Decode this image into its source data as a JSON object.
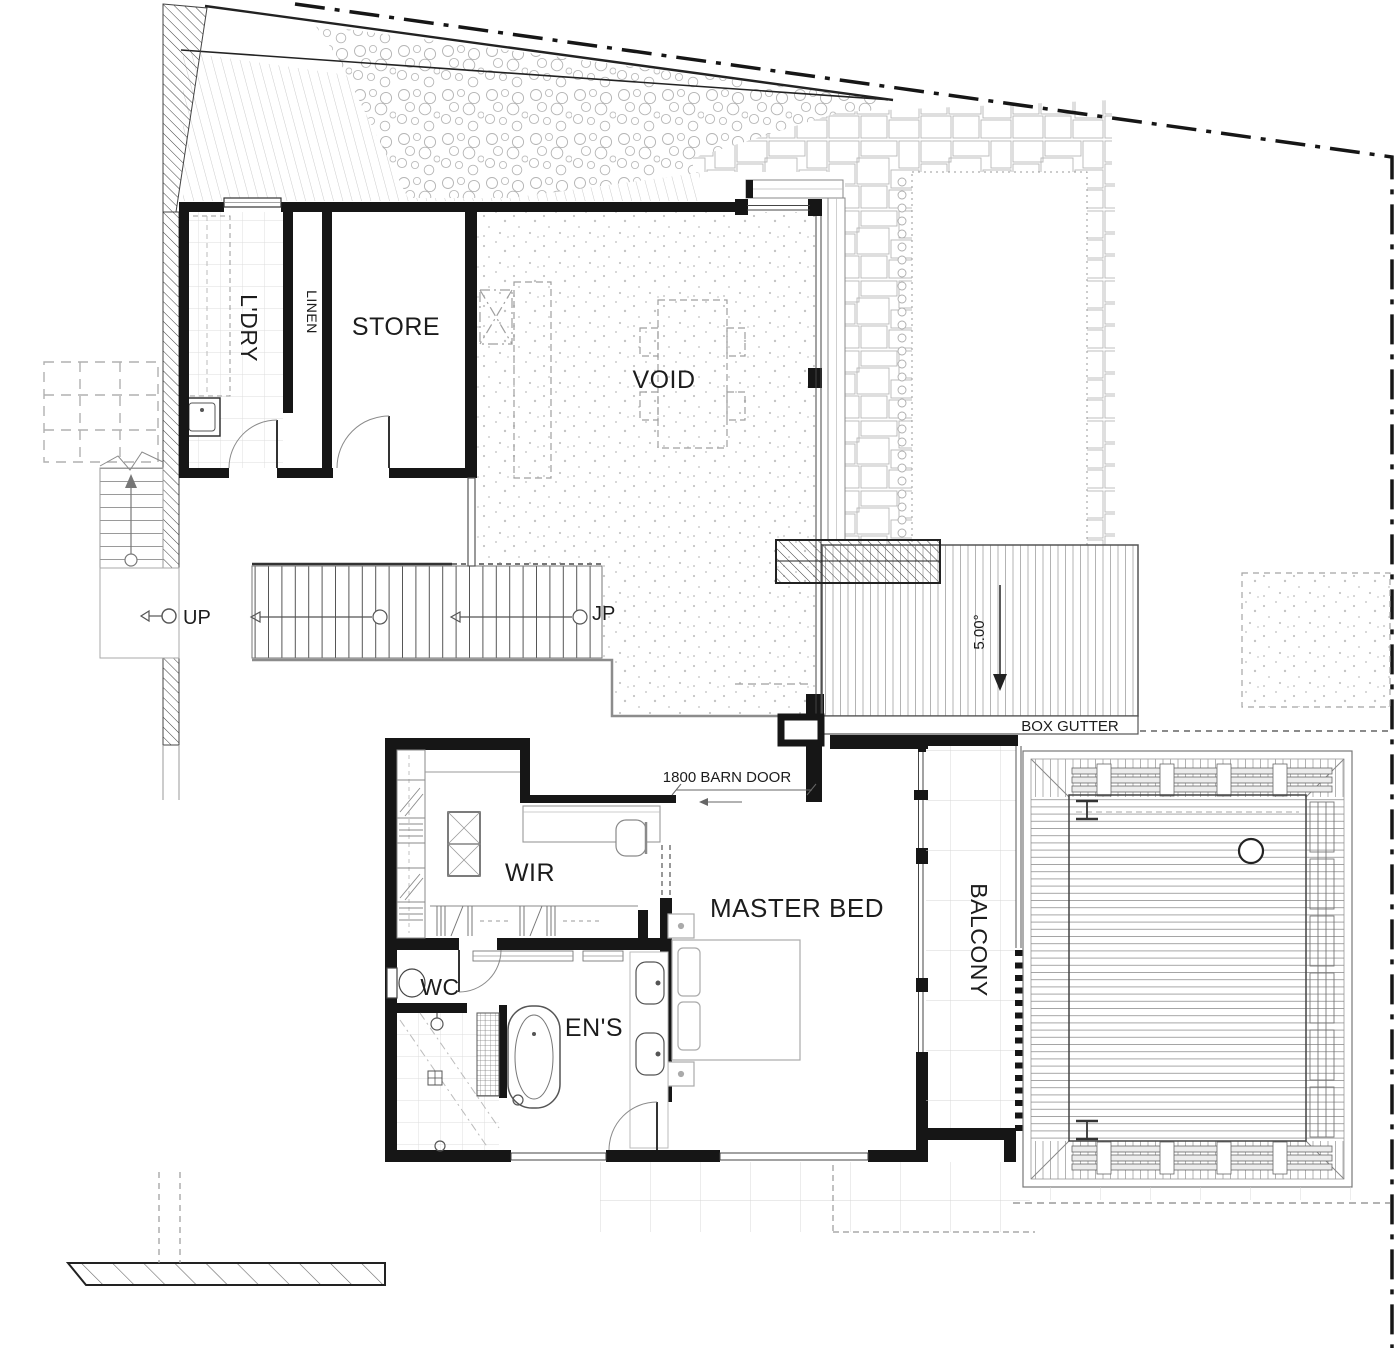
{
  "plan": {
    "rooms": {
      "laundry": "L'DRY",
      "linen": "LINEN",
      "store": "STORE",
      "void": "VOID",
      "wir": "WIR",
      "master_bed": "MASTER BED",
      "balcony": "BALCONY",
      "wc": "WC",
      "ensuite": "EN'S"
    },
    "annotations": {
      "up": "UP",
      "jp": "JP",
      "roof_pitch": "5.00°",
      "box_gutter": "BOX GUTTER",
      "barn_door": "1800 BARN DOOR"
    },
    "colors": {
      "ink": "#1c1c1c",
      "wall": "#161616",
      "light_line": "#b0b0b0",
      "paper": "#ffffff"
    }
  }
}
